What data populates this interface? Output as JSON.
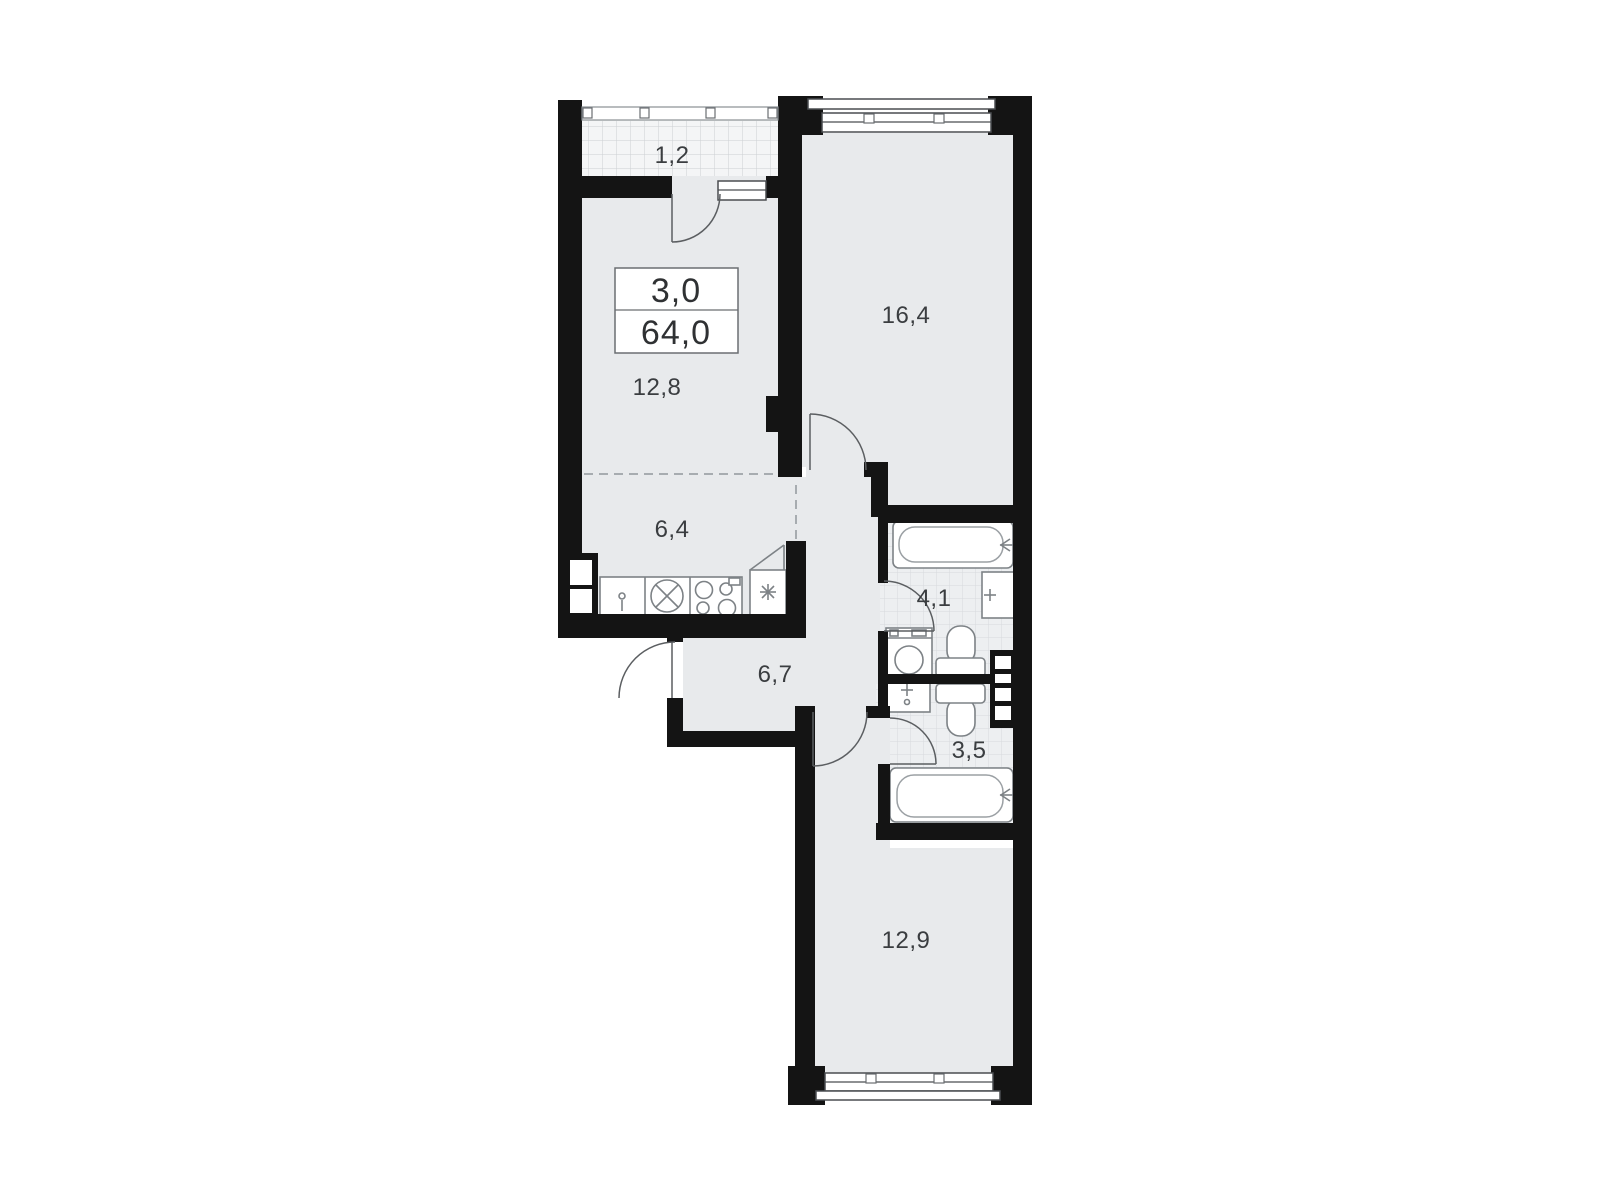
{
  "plan": {
    "title": "apartment-floor-plan",
    "info_box": {
      "rooms_count": "3,0",
      "total_area": "64,0"
    },
    "rooms": [
      {
        "name": "balcony",
        "area": "1,2"
      },
      {
        "name": "living-room",
        "area": "12,8"
      },
      {
        "name": "kitchen",
        "area": "6,4"
      },
      {
        "name": "bedroom-upper",
        "area": "16,4"
      },
      {
        "name": "hallway",
        "area": "6,7"
      },
      {
        "name": "bathroom",
        "area": "4,1"
      },
      {
        "name": "toilet-room",
        "area": "3,5"
      },
      {
        "name": "bedroom-lower",
        "area": "12,9"
      }
    ],
    "colors": {
      "wall": "#141414",
      "floor": "#e8eaec",
      "tile": "#edeff1",
      "tile_line": "#d7dadd",
      "balcony": "#f4f5f6",
      "grid_line": "#ccd0d3",
      "label": "#3a3d40",
      "fixture": "#7d8286",
      "door": "#5b5e61",
      "dashed": "#a7acb0"
    }
  }
}
